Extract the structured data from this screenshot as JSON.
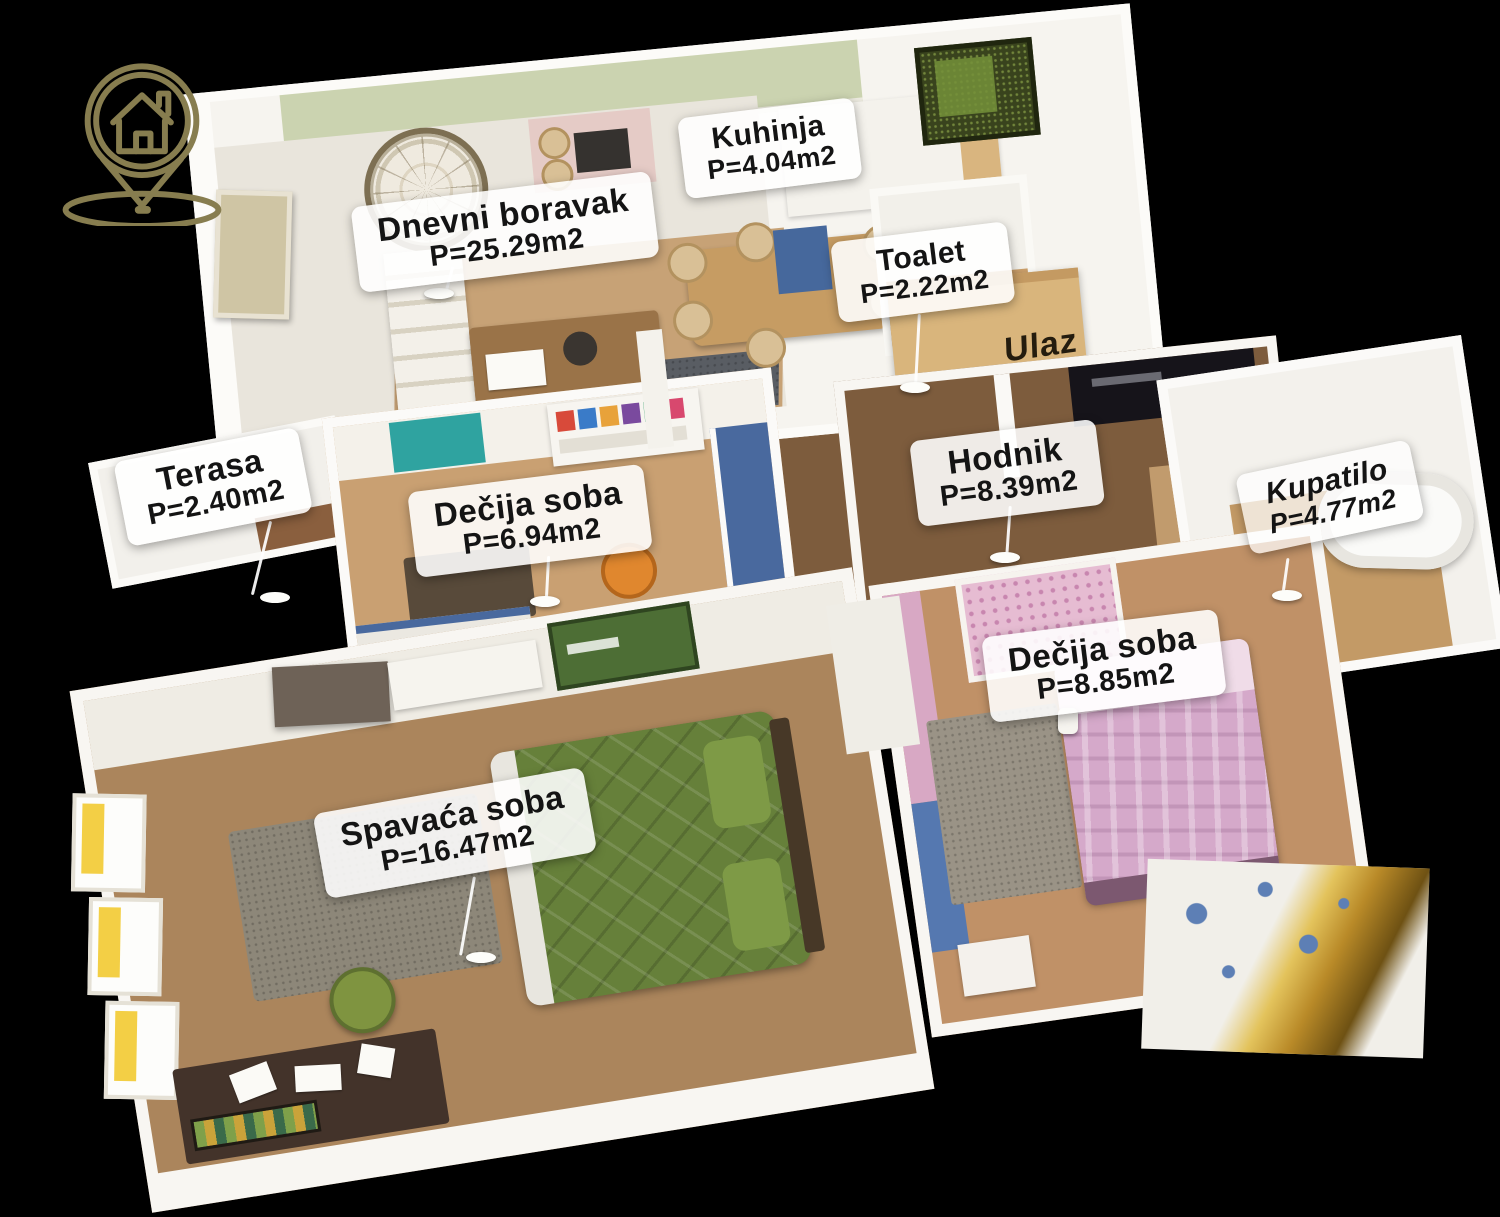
{
  "logo": {
    "icon": "house-location-pin-icon",
    "color": "#877d4f"
  },
  "labels": {
    "living": {
      "name": "Dnevni boravak",
      "area": "P=25.29m2"
    },
    "kitchen": {
      "name": "Kuhinja",
      "area": "P=4.04m2"
    },
    "toilet": {
      "name": "Toalet",
      "area": "P=2.22m2"
    },
    "entrance": {
      "name": "Ulaz"
    },
    "terrace": {
      "name": "Terasa",
      "area": "P=2.40m2"
    },
    "kids1": {
      "name": "Dečija soba",
      "area": "P=6.94m2"
    },
    "hallway": {
      "name": "Hodnik",
      "area": "P=8.39m2"
    },
    "bathroom": {
      "name": "Kupatilo",
      "area": "P=4.77m2"
    },
    "kids2": {
      "name": "Dečija soba",
      "area": "P=8.85m2"
    },
    "bedroom": {
      "name": "Spavaća soba",
      "area": "P=16.47m2"
    }
  },
  "palette": {
    "background": "#000000",
    "label_bg": "#ffffff",
    "label_text": "#141414",
    "logo_olive": "#877d4f",
    "wall_white": "#f8f6f2",
    "wood_light": "#c7a276",
    "wood_dark": "#7d5c3d",
    "sage_green": "#cbd3b0",
    "moss_green": "#39431d",
    "bed_green": "#66803a",
    "bed_pink": "#d5a9ca",
    "accent_blue": "#49699e",
    "accent_teal": "#2fa3a0",
    "accent_orange": "#e0872e",
    "gold_foil": "#b98a28",
    "window_yellow": "#f3cf45"
  }
}
